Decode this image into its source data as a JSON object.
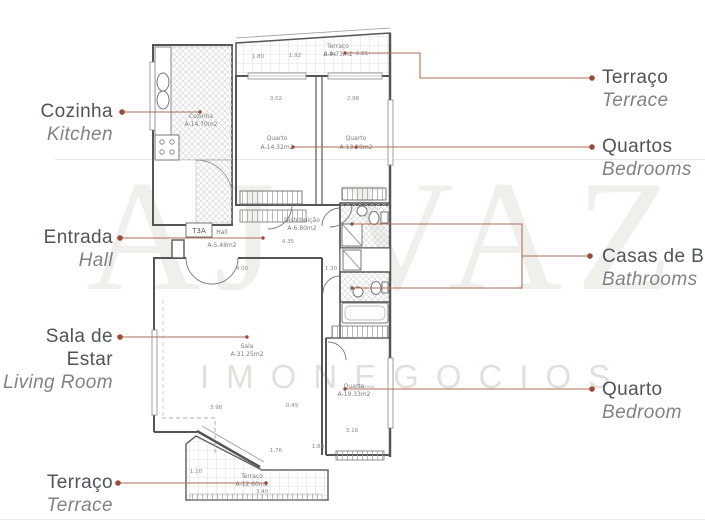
{
  "watermark": {
    "brand": "AJ VAZ",
    "sub": "IMONEGOCIOS"
  },
  "labels": {
    "left": [
      {
        "pt": "Cozinha",
        "en": "Kitchen"
      },
      {
        "pt": "Entrada",
        "en": "Hall"
      },
      {
        "pt": "Sala de Estar",
        "en": "Living Room"
      },
      {
        "pt": "Terraço",
        "en": "Terrace"
      }
    ],
    "right": [
      {
        "pt": "Terraço",
        "en": "Terrace"
      },
      {
        "pt": "Quartos",
        "en": "Bedrooms"
      },
      {
        "pt": "Casas de Banho",
        "en": "Bathrooms"
      },
      {
        "pt": "Quarto",
        "en": "Bedroom"
      }
    ]
  },
  "plan": {
    "unit": "T3A",
    "rooms": [
      {
        "name": "Cozinha",
        "area": "A-14.70m2"
      },
      {
        "name": "Terraço",
        "area": "A-9.73m2"
      },
      {
        "name": "Quarto",
        "area": "A-14.32m2"
      },
      {
        "name": "Quarto",
        "area": "A-13.28m2"
      },
      {
        "name": "Distribuição",
        "area": "A-6.80m2"
      },
      {
        "name": "Hall",
        "area": "A-5.48m2"
      },
      {
        "name": "Sala",
        "area": "A-31.25m2"
      },
      {
        "name": "Quarto",
        "area": "A-19.33m2"
      },
      {
        "name": "Terraço",
        "area": "A-12.60m2"
      }
    ],
    "dims": [
      {
        "t": "1.80"
      },
      {
        "t": "1.92"
      },
      {
        "t": "2.44"
      },
      {
        "t": "1.21"
      },
      {
        "t": "3.02"
      },
      {
        "t": "2.98"
      },
      {
        "t": "4.35"
      },
      {
        "t": "4.00"
      },
      {
        "t": "1.30"
      },
      {
        "t": "3.98"
      },
      {
        "t": "0.49"
      },
      {
        "t": "1.76"
      },
      {
        "t": "1.80"
      },
      {
        "t": "3.16"
      },
      {
        "t": "1.10"
      },
      {
        "t": "3.40"
      }
    ]
  },
  "colors": {
    "leader": "#ad6e55",
    "dot": "#9a4a36",
    "wall": "#555555",
    "plan_text": "#7b7b7b"
  }
}
